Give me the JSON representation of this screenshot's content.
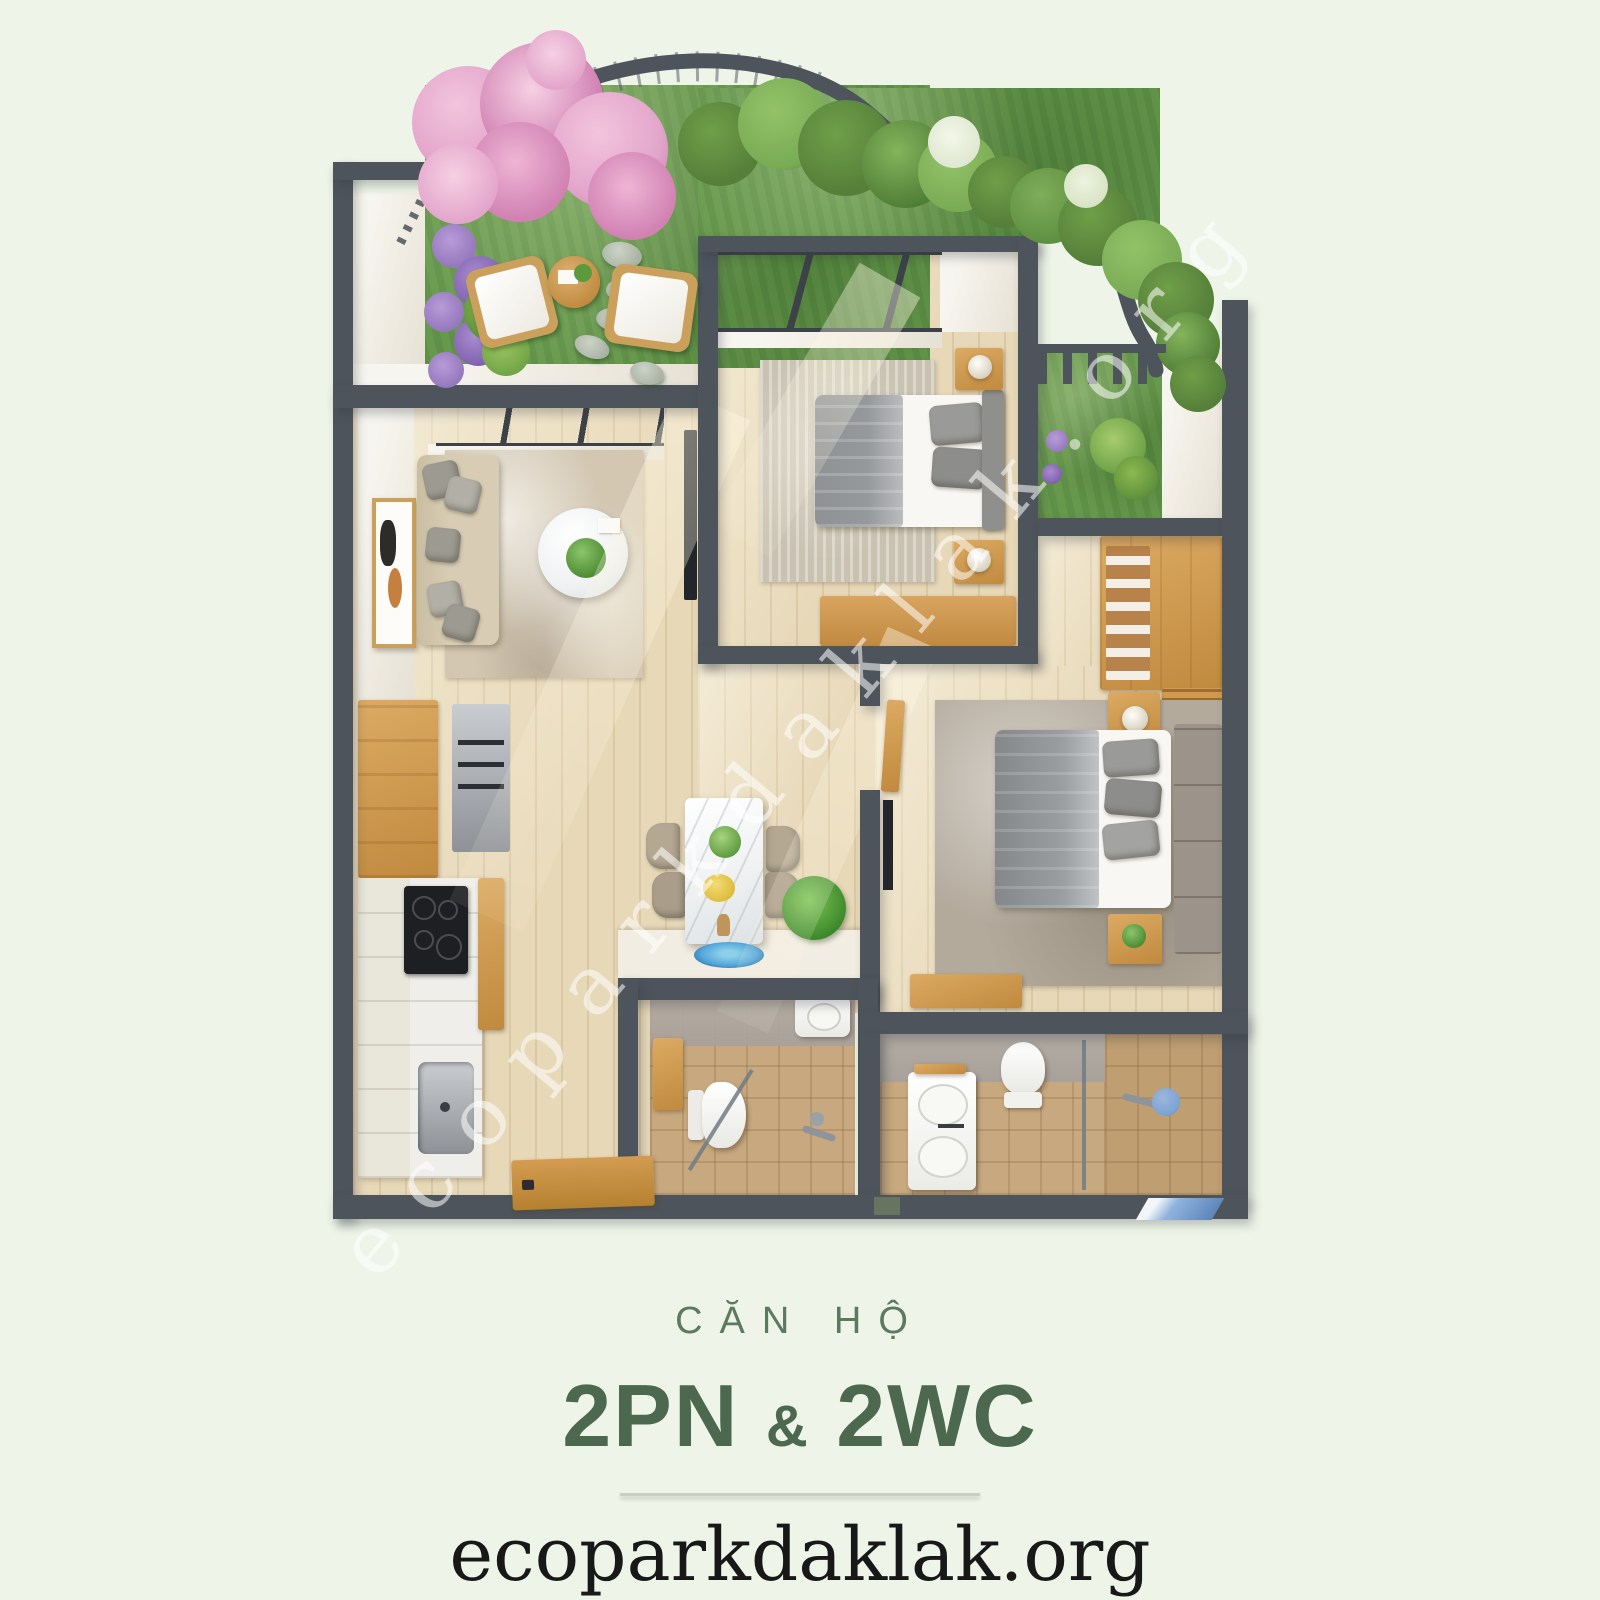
{
  "caption": {
    "kicker": "CĂN HỘ",
    "title_left": "2PN",
    "title_amp": "&",
    "title_right": "2WC",
    "website": "ecoparkdaklak.org"
  },
  "watermark": {
    "text": "ecoparkdaklak.org"
  },
  "colors": {
    "bg": "#eef5e8",
    "wall": "#4d545b",
    "floor": "#e7d8b8",
    "grass": "#67994d",
    "foliage": "#567f3a",
    "foliageLight": "#79ab55",
    "flowerPink": "#e3a6cb",
    "flowerPinkDeep": "#d182b3",
    "flowerPurple": "#9678bd",
    "rugLiving": "#d3c7b2",
    "rugBed1": "#c9c2b1",
    "rugBed2": "#b3aa9c",
    "sofa": "#d8cdb4",
    "cushion": "#9d9a91",
    "bedWhite": "#f8f7f3",
    "duvet": "#96999c",
    "marble": "#eff1f2",
    "platform": "#f2ede2",
    "tileFloor": "#c7a87f",
    "tileWall": "#a8a19a",
    "blueRug": "#56a8dc",
    "blueGlass": "#7aa3d6",
    "kicker": "#5c7a5f",
    "title": "#4c684e",
    "text": "#181818",
    "divider": "#c9cfc2"
  }
}
